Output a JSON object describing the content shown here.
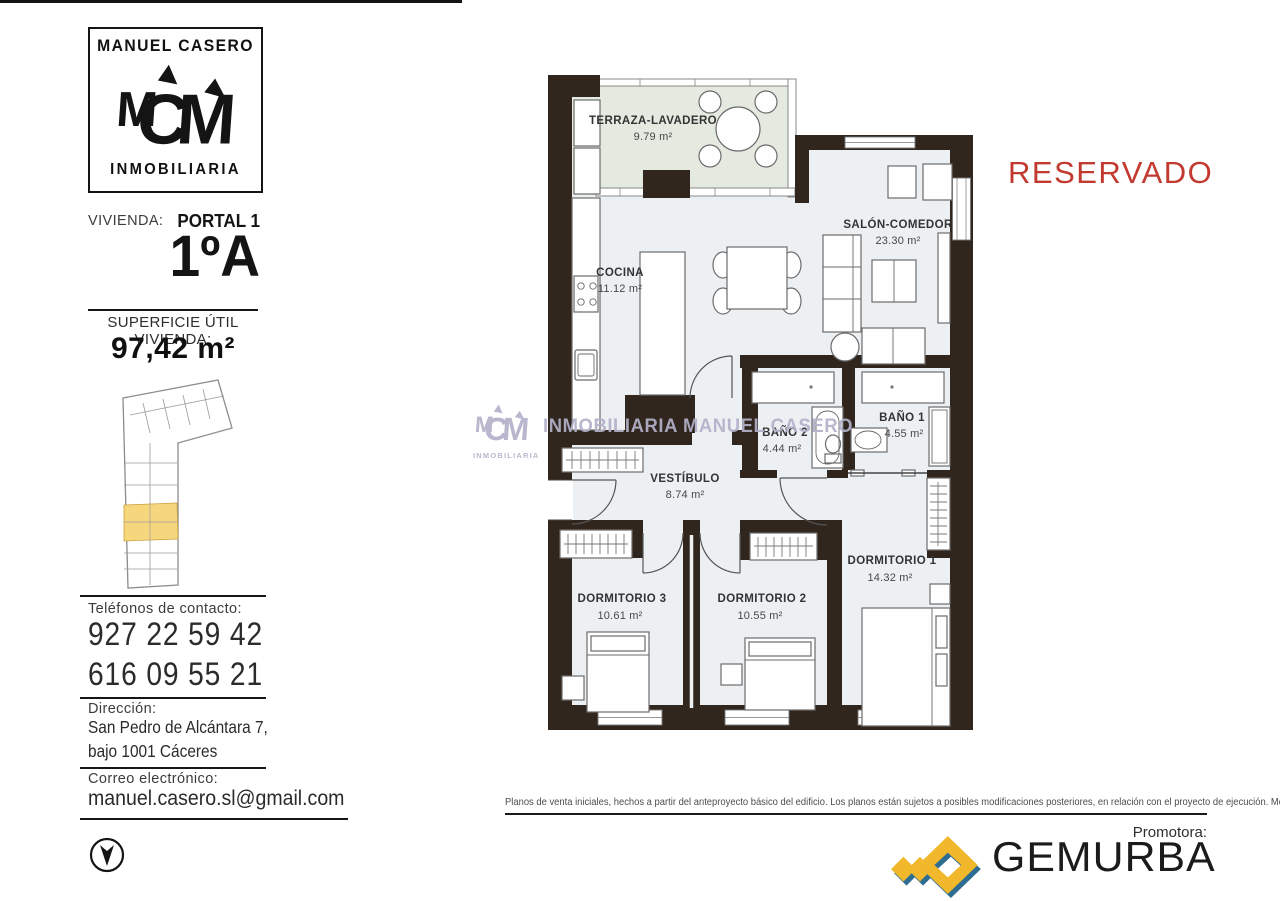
{
  "status": "RESERVADO",
  "agency": {
    "name_top": "MANUEL CASERO",
    "name_bottom": "INMOBILIARIA"
  },
  "listing": {
    "vivienda_label": "VIVIENDA:",
    "portal": "PORTAL 1",
    "unit": "1ºA",
    "superficie_label": "SUPERFICIE ÚTIL VIVIENDA:",
    "superficie_value": "97,42 m²"
  },
  "contact": {
    "phones_label": "Teléfonos de contacto:",
    "phone1": "927 22 59 42",
    "phone2": "616  09 55 21",
    "address_label": "Dirección:",
    "address_line1": "San Pedro de Alcántara 7,",
    "address_line2": "bajo 1001 Cáceres",
    "email_label": "Correo electrónico:",
    "email": "manuel.casero.sl@gmail.com"
  },
  "plan": {
    "watermark": "INMOBILIARIA MANUEL CASERO",
    "watermark_logo_sub": "INMOBILIARIA",
    "rooms": [
      {
        "name": "TERRAZA-LAVADERO",
        "area": "9.79 m²"
      },
      {
        "name": "SALÓN-COMEDOR",
        "area": "23.30 m²"
      },
      {
        "name": "COCINA",
        "area": "11.12 m²"
      },
      {
        "name": "BAÑO 2",
        "area": "4.44 m²"
      },
      {
        "name": "BAÑO 1",
        "area": "4.55 m²"
      },
      {
        "name": "VESTÍBULO",
        "area": "8.74 m²"
      },
      {
        "name": "DORMITORIO 3",
        "area": "10.61 m²"
      },
      {
        "name": "DORMITORIO 2",
        "area": "10.55 m²"
      },
      {
        "name": "DORMITORIO 1",
        "area": "14.32 m²"
      }
    ]
  },
  "footer": {
    "disclaimer": "Planos de venta iniciales, hechos a partir del anteproyecto básico del edificio. Los planos están sujetos a posibles modificaciones posteriores, en relación con el proyecto de ejecución. Mobiliario no incluido.",
    "promotora_label": "Promotora:",
    "promotora_name": "GEMURBA"
  },
  "colors": {
    "wall": "#31261e",
    "reserved_red": "#c2392f",
    "watermark": "#b3b1c9",
    "site_highlight": "#f6d77d",
    "gemurba_yellow": "#f2b82c",
    "gemurba_blue": "#2e6d92"
  }
}
